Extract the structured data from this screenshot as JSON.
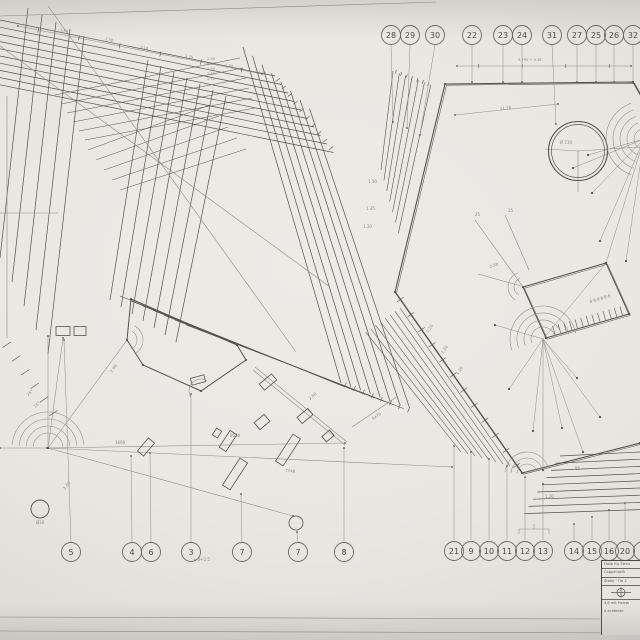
{
  "meta": {
    "sheet_type": "technical pencil drawing, photographed",
    "ink": "#55524d",
    "ink_light": "#8f8b85",
    "paper": "#e9e7e2"
  },
  "title_block": {
    "row1": "Halle für Streu",
    "row2": "Coppenrath",
    "row3": "Statik · Tle 2",
    "row4": "3,8 mit Holzw.",
    "row5": "4 achtecke"
  },
  "drawing": {
    "balloons": {
      "r": 9.5,
      "top": {
        "y": 35,
        "items": [
          {
            "n": "28",
            "x": 391
          },
          {
            "n": "29",
            "x": 410
          },
          {
            "n": "30",
            "x": 435
          },
          {
            "n": "22",
            "x": 472
          },
          {
            "n": "23",
            "x": 503
          },
          {
            "n": "24",
            "x": 522
          },
          {
            "n": "31",
            "x": 552
          },
          {
            "n": "27",
            "x": 577
          },
          {
            "n": "25",
            "x": 596
          },
          {
            "n": "26",
            "x": 614
          },
          {
            "n": "32",
            "x": 633
          }
        ]
      },
      "bottom_left": {
        "y": 552,
        "items": [
          {
            "n": "5",
            "x": 71
          },
          {
            "n": "4",
            "x": 132
          },
          {
            "n": "6",
            "x": 151
          },
          {
            "n": "3",
            "x": 191
          },
          {
            "n": "7",
            "x": 242
          },
          {
            "n": "7",
            "x": 298
          },
          {
            "n": "8",
            "x": 344
          }
        ]
      },
      "bottom_right": {
        "y": 551,
        "items": [
          {
            "n": "21",
            "x": 454
          },
          {
            "n": "9",
            "x": 471
          },
          {
            "n": "10",
            "x": 489
          },
          {
            "n": "11",
            "x": 507
          },
          {
            "n": "12",
            "x": 525
          },
          {
            "n": "13",
            "x": 543
          },
          {
            "n": "14",
            "x": 574
          },
          {
            "n": "15",
            "x": 592
          },
          {
            "n": "16",
            "x": 609
          },
          {
            "n": "20",
            "x": 625
          },
          {
            "n": "",
            "x": 643
          }
        ]
      }
    },
    "bands": [
      {
        "s": [
          0,
          20
        ],
        "e": [
          275,
          76
        ],
        "ds": [
          0,
          7.2
        ],
        "de": [
          6.5,
          8.5
        ],
        "n": 10,
        "w": 0.7
      },
      {
        "s": [
          243,
          47
        ],
        "e": [
          341,
          383
        ],
        "ds": [
          9.5,
          8.8
        ],
        "de": [
          9.8,
          3.6
        ],
        "n": 8,
        "w": 0.7
      },
      {
        "s": [
          120,
          296
        ],
        "e": [
          345,
          387
        ],
        "ds": [
          11,
          4.8
        ],
        "de": [
          9.8,
          3.6
        ],
        "n": 7,
        "w": 0.6
      },
      {
        "s": [
          148,
          60
        ],
        "e": [
          110,
          300
        ],
        "ds": [
          13,
          6
        ],
        "de": [
          11,
          7
        ],
        "n": 7,
        "w": 0.7
      },
      {
        "s": [
          28,
          8
        ],
        "e": [
          0,
          258
        ],
        "ds": [
          14,
          7
        ],
        "de": [
          12,
          24
        ],
        "n": 5,
        "w": 0.7
      },
      {
        "s": [
          55,
          95
        ],
        "e": [
          240,
          58
        ],
        "ds": [
          6,
          9
        ],
        "de": [
          3,
          10
        ],
        "n": 6,
        "w": 0.5
      },
      {
        "s": [
          88,
          150
        ],
        "e": [
          210,
          105
        ],
        "ds": [
          8,
          10
        ],
        "de": [
          9,
          11
        ],
        "n": 5,
        "w": 0.5
      },
      {
        "s": [
          393,
          71
        ],
        "e": [
          381,
          170
        ],
        "ds": [
          6.3,
          2.3
        ],
        "de": [
          2.9,
          10.5
        ],
        "n": 7,
        "w": 0.6
      },
      {
        "s": [
          400,
          308
        ],
        "e": [
          510,
          466
        ],
        "ds": [
          -4.9,
          3.44
        ],
        "de": [
          -7,
          -2
        ],
        "n": 8,
        "w": 0.55
      },
      {
        "s": [
          560,
          456
        ],
        "e": [
          640,
          452
        ],
        "ds": [
          -4.5,
          7.2
        ],
        "de": [
          0,
          7.2
        ],
        "n": 9,
        "w": 0.7
      }
    ],
    "polys": [
      {
        "pts": [
          [
            641,
            96
          ],
          [
            633,
            82
          ],
          [
            445,
            84
          ],
          [
            395,
            292
          ],
          [
            522,
            473
          ],
          [
            640,
            443
          ]
        ],
        "close": false,
        "w": 1.1,
        "double": true
      },
      {
        "pts": [
          [
            131,
            299
          ],
          [
            237,
            345
          ],
          [
            246,
            360
          ],
          [
            201,
            391
          ],
          [
            143,
            365
          ],
          [
            127,
            340
          ]
        ],
        "close": true,
        "w": 1.0,
        "double": false
      },
      {
        "pts": [
          [
            523,
            287
          ],
          [
            606,
            263
          ],
          [
            629,
            314
          ],
          [
            546,
            338
          ]
        ],
        "close": true,
        "w": 1.0,
        "double": true
      }
    ],
    "segs": [
      [
        0,
        16,
        436,
        2
      ],
      [
        7,
        96,
        7,
        338
      ],
      [
        0,
        213,
        58,
        213
      ],
      [
        0,
        46,
        330,
        287
      ],
      [
        48,
        6,
        296,
        352
      ],
      [
        253,
        370,
        345,
        445
      ],
      [
        255,
        367,
        347,
        442
      ],
      [
        578,
        151,
        545,
        149
      ],
      [
        578,
        151,
        578,
        192
      ],
      [
        578,
        151,
        640,
        147
      ],
      [
        475,
        220,
        523,
        287
      ],
      [
        505,
        215,
        529,
        270
      ],
      [
        352,
        427,
        398,
        396
      ],
      [
        478,
        274,
        521,
        286
      ],
      [
        519,
        529,
        549,
        529
      ],
      [
        519,
        529,
        519,
        534
      ],
      [
        549,
        529,
        549,
        534
      ],
      [
        534,
        529,
        534,
        524
      ],
      [
        0,
        617,
        600,
        619
      ],
      [
        0,
        631,
        640,
        633
      ]
    ],
    "dimsegs": [
      [
        48,
        448,
        345,
        443
      ],
      [
        48,
        448,
        452,
        467
      ],
      [
        48,
        448,
        127,
        340
      ],
      [
        48,
        448,
        293,
        516
      ],
      [
        48,
        448,
        63,
        338
      ],
      [
        0,
        448,
        47,
        448
      ],
      [
        48,
        336,
        48,
        448
      ],
      [
        18,
        26,
        262,
        74
      ],
      [
        457,
        66,
        631,
        66
      ],
      [
        455,
        115,
        558,
        104
      ]
    ],
    "ticksets": [
      {
        "s": [
          18,
          26
        ],
        "e": [
          262,
          74
        ],
        "n": 6,
        "len": 5
      },
      {
        "s": [
          457,
          66
        ],
        "e": [
          631,
          66
        ],
        "n": 4,
        "len": 4
      },
      {
        "s": [
          395,
          292
        ],
        "e": [
          522,
          473
        ],
        "n": 12,
        "len": 8
      },
      {
        "s": [
          341,
          383
        ],
        "e": [
          413,
          412
        ],
        "n": 8,
        "len": 5
      },
      {
        "s": [
          275,
          76
        ],
        "e": [
          334,
          152
        ],
        "n": 10,
        "len": 5
      },
      {
        "s": [
          393,
          71
        ],
        "e": [
          431,
          85
        ],
        "n": 7,
        "len": 4
      },
      {
        "s": [
          551,
          331
        ],
        "e": [
          624,
          310
        ],
        "n": 13,
        "len": 9
      },
      {
        "s": [
          2,
          338
        ],
        "e": [
          58,
          420
        ],
        "n": 6,
        "len": 10
      }
    ],
    "rays": [
      [
        543,
        339,
        495,
        325
      ],
      [
        543,
        339,
        509,
        389
      ],
      [
        543,
        339,
        533,
        431
      ],
      [
        543,
        339,
        543,
        470
      ],
      [
        543,
        339,
        562,
        428
      ],
      [
        543,
        339,
        583,
        452
      ],
      [
        543,
        339,
        600,
        417
      ],
      [
        543,
        339,
        577,
        378
      ],
      [
        543,
        339,
        606,
        263
      ],
      [
        644,
        139,
        592,
        193
      ],
      [
        644,
        139,
        600,
        241
      ],
      [
        644,
        139,
        626,
        261
      ],
      [
        644,
        139,
        606,
        263
      ],
      [
        644,
        139,
        573,
        168
      ],
      [
        644,
        139,
        588,
        155
      ]
    ],
    "leaders": [
      [
        391,
        45,
        393,
        122
      ],
      [
        410,
        45,
        407,
        128
      ],
      [
        435,
        45,
        420,
        135
      ],
      [
        472,
        45,
        472,
        82
      ],
      [
        503,
        45,
        503,
        82
      ],
      [
        522,
        45,
        522,
        82
      ],
      [
        552,
        45,
        556,
        124
      ],
      [
        577,
        45,
        577,
        82
      ],
      [
        596,
        45,
        596,
        82
      ],
      [
        614,
        45,
        614,
        82
      ],
      [
        633,
        45,
        633,
        82
      ],
      [
        71,
        542,
        64,
        340
      ],
      [
        132,
        542,
        131,
        456
      ],
      [
        151,
        542,
        150,
        453
      ],
      [
        191,
        542,
        191,
        394
      ],
      [
        242,
        542,
        241,
        494
      ],
      [
        298,
        542,
        297,
        532
      ],
      [
        344,
        542,
        344,
        448
      ],
      [
        454,
        540,
        454,
        446
      ],
      [
        471,
        540,
        471,
        452
      ],
      [
        489,
        540,
        489,
        459
      ],
      [
        507,
        540,
        507,
        466
      ],
      [
        525,
        540,
        525,
        477
      ],
      [
        543,
        540,
        543,
        484
      ],
      [
        574,
        540,
        574,
        524
      ],
      [
        592,
        540,
        592,
        517
      ],
      [
        609,
        540,
        609,
        510
      ],
      [
        625,
        540,
        625,
        503
      ]
    ],
    "rects": [
      [
        228,
        441,
        20,
        8,
        -57
      ],
      [
        262,
        422,
        13,
        9,
        -40
      ],
      [
        146,
        447,
        17,
        8,
        -50
      ],
      [
        235,
        474,
        32,
        9,
        -57
      ],
      [
        288,
        450,
        32,
        9,
        -57
      ],
      [
        198,
        380,
        14,
        7,
        -15
      ],
      [
        63,
        331,
        14,
        9,
        0
      ],
      [
        80,
        331,
        12,
        9,
        0
      ],
      [
        268,
        382,
        16,
        8,
        -40
      ],
      [
        305,
        416,
        14,
        8,
        -40
      ],
      [
        328,
        436,
        10,
        7,
        -40
      ],
      [
        217,
        433,
        8,
        6,
        -57
      ]
    ],
    "circles": [
      [
        578,
        151,
        29.5,
        1.1
      ],
      [
        578,
        151,
        26.5,
        0.7
      ],
      [
        40,
        509,
        9,
        0.9
      ],
      [
        296,
        523,
        7,
        0.8
      ]
    ],
    "arcsets": [
      {
        "c": [
          48,
          448
        ],
        "radii": [
          15,
          22,
          29,
          36
        ],
        "a0": 185,
        "a1": 355
      },
      {
        "c": [
          543,
          339
        ],
        "radii": [
          12,
          19,
          26,
          33
        ],
        "a0": 160,
        "a1": 350
      },
      {
        "c": [
          644,
          139
        ],
        "radii": [
          10,
          17,
          24,
          31,
          38
        ],
        "a0": 110,
        "a1": 250
      },
      {
        "c": [
          127,
          340
        ],
        "radii": [
          10,
          16
        ],
        "a0": 300,
        "a1": 415
      },
      {
        "c": [
          201,
          391
        ],
        "radii": [
          12
        ],
        "a0": 150,
        "a1": 300
      },
      {
        "c": [
          523,
          287
        ],
        "radii": [
          9,
          15
        ],
        "a0": 120,
        "a1": 250
      },
      {
        "c": [
          527,
          474
        ],
        "radii": [
          10,
          16,
          22
        ],
        "a0": 185,
        "a1": 340
      }
    ],
    "labels": [
      [
        60,
        31,
        12,
        "2.50"
      ],
      [
        105,
        40,
        12,
        "2.50"
      ],
      [
        140,
        48,
        12,
        "3.10"
      ],
      [
        185,
        57,
        12,
        "1.75"
      ],
      [
        225,
        66,
        12,
        "2.50"
      ],
      [
        258,
        73,
        12,
        "1.40"
      ],
      [
        207,
        60,
        0,
        "2.50"
      ],
      [
        207,
        65,
        0,
        "2.50"
      ],
      [
        207,
        70,
        0,
        "2.50"
      ],
      [
        207,
        75,
        0,
        "2.50"
      ],
      [
        207,
        80,
        0,
        "2.50"
      ],
      [
        112,
        373,
        -55,
        "2.98"
      ],
      [
        230,
        437,
        0,
        "8500"
      ],
      [
        115,
        444,
        0,
        "1660"
      ],
      [
        285,
        472,
        4,
        "7748"
      ],
      [
        65,
        490,
        -50,
        "2.50"
      ],
      [
        35,
        408,
        -40,
        "15°"
      ],
      [
        28,
        396,
        -40,
        "25°"
      ],
      [
        368,
        183,
        0,
        "1.50"
      ],
      [
        366,
        210,
        0,
        "1.35"
      ],
      [
        363,
        228,
        0,
        "1.20"
      ],
      [
        518,
        61,
        0,
        "4.790 + 4.16"
      ],
      [
        500,
        110,
        -6,
        "11.20"
      ],
      [
        560,
        144,
        0,
        "Ø 730"
      ],
      [
        490,
        268,
        -17,
        "2.50"
      ],
      [
        475,
        216,
        0,
        "25"
      ],
      [
        508,
        212,
        0,
        "25"
      ],
      [
        373,
        420,
        -33,
        "4x70"
      ],
      [
        310,
        400,
        -40,
        "2.50"
      ],
      [
        428,
        333,
        -55,
        "1.20"
      ],
      [
        443,
        354,
        -55,
        "1.20"
      ],
      [
        458,
        375,
        -55,
        "1.20"
      ],
      [
        590,
        303,
        -16,
        "8·8·8·8·8·8"
      ],
      [
        545,
        498,
        0,
        "1.20"
      ],
      [
        575,
        470,
        0,
        "85"
      ],
      [
        193,
        561,
        0,
        "± 0+2.5"
      ],
      [
        36,
        524,
        0,
        "Ø30"
      ]
    ]
  }
}
